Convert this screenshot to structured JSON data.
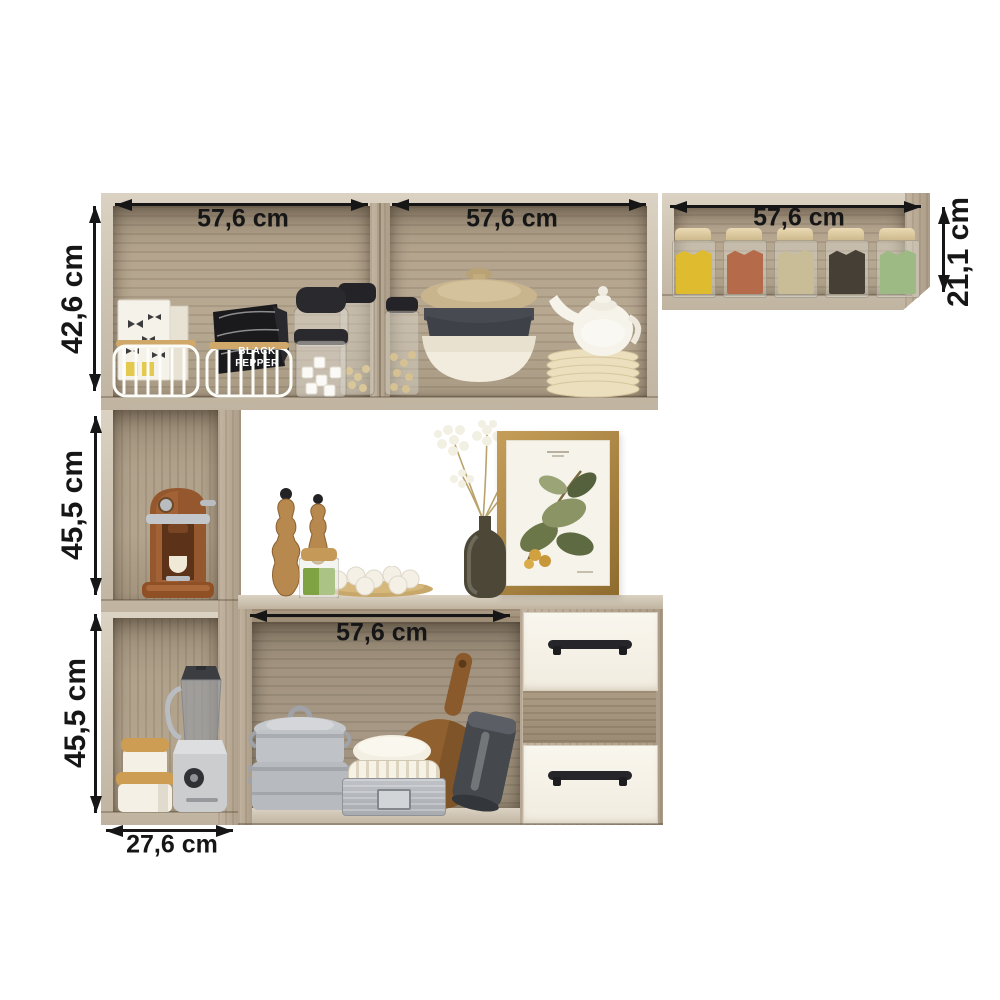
{
  "page": {
    "background": "#ffffff",
    "kind": "furniture dimension diagram"
  },
  "dimensions": {
    "top_left_cabinet_width": "57,6 cm",
    "top_middle_cabinet_width": "57,6 cm",
    "top_right_shelf_width": "57,6 cm",
    "top_left_cabinet_height": "42,6 cm",
    "middle_left_cabinet_height": "45,5 cm",
    "bottom_left_cabinet_height": "45,5 cm",
    "top_right_shelf_height": "21,1 cm",
    "base_niche_width": "57,6 cm",
    "bottom_left_cabinet_width": "27,6 cm"
  },
  "labels": {
    "pepper_bag": "BLACK PEPPER"
  },
  "colors": {
    "background": "#ffffff",
    "wood_frame": "#cfc5b4",
    "wood_side": "#ab9d87",
    "wood_interior": "#b0a18b",
    "wood_niche": "#998a76",
    "drawer_front": "#f5f2e8",
    "handle": "#26262a",
    "dimension_text": "#161616",
    "frame_gold": "#b5904d",
    "spice_fills": [
      "#dfbc2f",
      "#b56a49",
      "#c9bd97",
      "#463f35",
      "#9db984"
    ]
  },
  "decor_items": [
    "wire-basket-with-pasta-boxes",
    "wire-basket-with-pepper-bag",
    "glass-storage-jars",
    "pot-with-beige-lid-and-bowls",
    "white-teapot-on-plate-stack",
    "five-spice-grain-jars",
    "espresso-coffee-machine",
    "wooden-pepper-mills",
    "green-tea-jar",
    "plate-of-eggs",
    "vase-with-white-flowers",
    "botanical-framed-print",
    "stacked-metal-pots",
    "white-ceramic-bowl",
    "white-fluted-dish",
    "metal-storage-box",
    "round-cutting-board",
    "dark-roasting-pan",
    "white-canisters-with-wood-lids",
    "blender"
  ]
}
